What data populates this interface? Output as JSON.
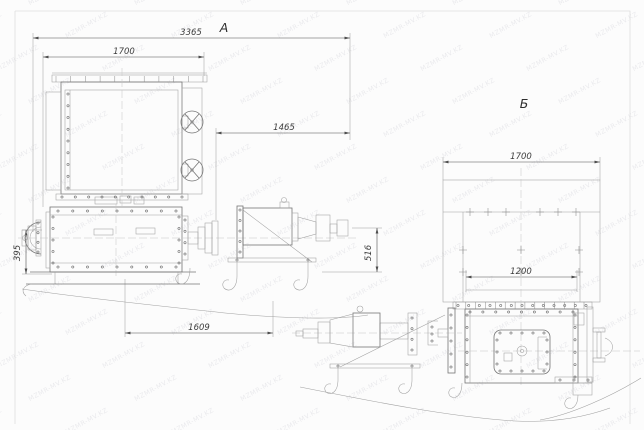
{
  "drawing": {
    "watermark_text": "MZMR-MV.KZ",
    "view_a": {
      "label": "А",
      "dims": {
        "overall_length": "3365",
        "hopper_width": "1700",
        "drive_length": "1465",
        "left_height": "395",
        "drive_height": "516",
        "base_length": "1609"
      }
    },
    "view_b": {
      "label": "Б",
      "dims": {
        "hopper_width": "1700",
        "outlet_width": "1200"
      }
    }
  }
}
